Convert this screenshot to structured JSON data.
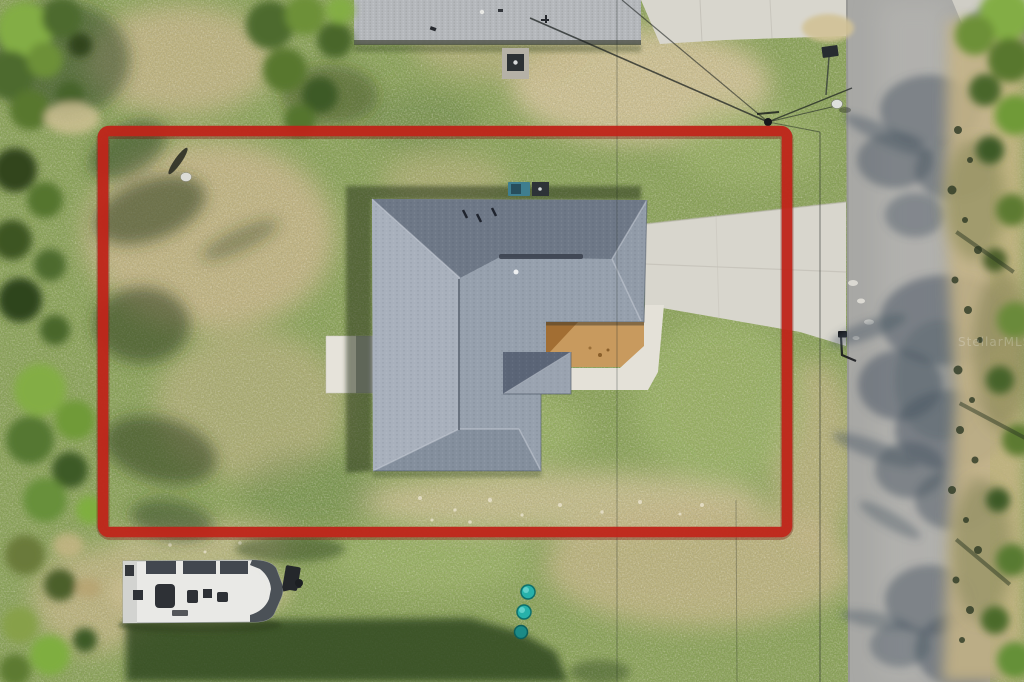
{
  "scene": {
    "description": "Aerial drone photograph of a single-family home lot outlined with a red property boundary, with a road on the right, an RV trailer parked below the lot, and trees along the edges",
    "type": "aerial-photograph",
    "watermark": "StellarMLS"
  },
  "boundary": {
    "shape": "rectangle",
    "label": "property-boundary",
    "color": "#c1251a"
  },
  "objects": [
    {
      "name": "main-house-roof",
      "description": "gray hip-roof house in center of lot"
    },
    {
      "name": "entry-courtyard",
      "description": "tan unfinished courtyard at front entry"
    },
    {
      "name": "driveway",
      "description": "concrete driveway from house to road"
    },
    {
      "name": "road",
      "description": "asphalt road running vertically on right"
    },
    {
      "name": "neighbor-house-roof",
      "description": "neighboring roof at top edge"
    },
    {
      "name": "rv-trailer",
      "description": "white travel trailer parked below the lot"
    },
    {
      "name": "satellite-dish",
      "description": "small satellite dish in the yard"
    },
    {
      "name": "utility-pole",
      "description": "utility pole with overhead power lines"
    },
    {
      "name": "mailbox",
      "description": "mailbox at the road edge"
    },
    {
      "name": "teal-buckets",
      "description": "three teal buckets on the lawn"
    },
    {
      "name": "tree-shadows",
      "description": "tree shadows cast across the road"
    }
  ],
  "colors": {
    "boundary-red": "#c1251a",
    "boundary-red-dark": "#6f120c",
    "grass-base": "#86a054",
    "grass-bright": "#9ab364",
    "grass-dark": "#5c7a3c",
    "dry-grass": "#c7b586",
    "dirt-sand": "#d2c296",
    "road-asphalt": "#a8a8a5",
    "road-light": "#bab9b5",
    "concrete": "#d8d6cd",
    "concrete-bright": "#e4e1d8",
    "roof-base": "#96a0ad",
    "roof-light": "#aeb5c1",
    "roof-dark": "#6c7685",
    "roof-ridge": "#3c4350",
    "neighbor-roof": "#b4b7bb",
    "courtyard-tan": "#c89a5e",
    "courtyard-dark": "#a06c30",
    "tree-dark": "#31451f",
    "tree-mid": "#4e6a2e",
    "tree-bright": "#83ad45",
    "shadow-road": "#4b5864",
    "shadow-grass": "#2d3f1e",
    "trailer-body": "#e9e9e6",
    "trailer-roof": "#42474f",
    "bucket-teal": "#27b1aa",
    "ac-teal": "#3f7e8f"
  }
}
